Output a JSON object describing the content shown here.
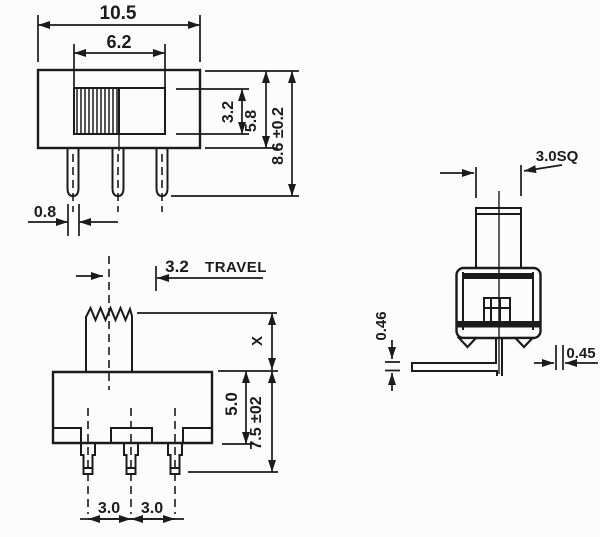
{
  "colors": {
    "ink": "#1b1b1b",
    "paper": "#fcfcfc"
  },
  "front_view": {
    "overall_width": "10.5",
    "slot_width": "6.2",
    "slot_height": "3.2",
    "body_height": "5.8",
    "overall_height": "8.6 ±0.2",
    "terminal_width": "0.8"
  },
  "side_view": {
    "travel_value": "3.2",
    "travel_word": "TRAVEL",
    "actuator_height": "X",
    "body_height": "5.0",
    "overall_height": "7.5 ±02",
    "pitch_left": "3.0",
    "pitch_right": "3.0"
  },
  "end_view": {
    "actuator_square": "3.0SQ",
    "lead_thickness": "0.46",
    "lead_width": "0.45"
  }
}
